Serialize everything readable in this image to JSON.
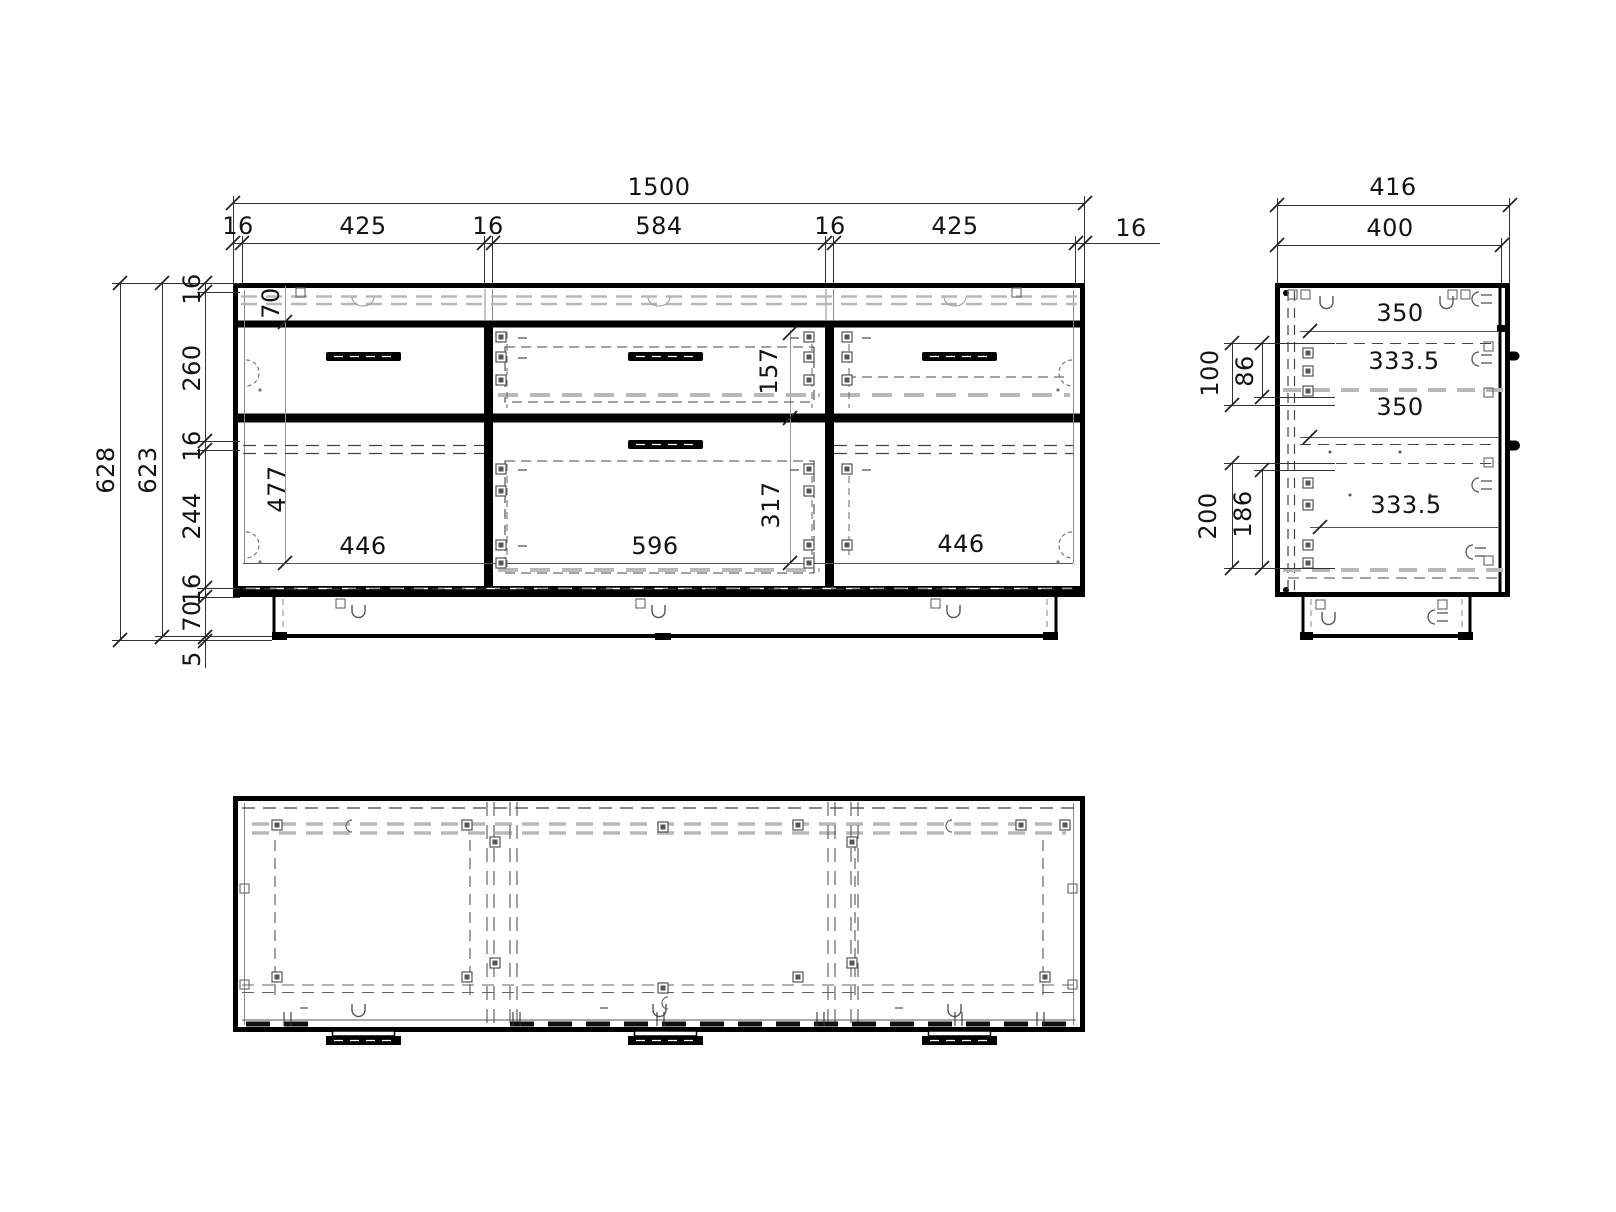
{
  "drawing": {
    "front": {
      "total_width": "1500",
      "width_segments": [
        "16",
        "425",
        "16",
        "584",
        "16",
        "425",
        "16"
      ],
      "total_height": "628",
      "body_height": "623",
      "height_segments": [
        "16",
        "260",
        "16",
        "244",
        "16",
        "70"
      ],
      "foot_height": "5",
      "top_rail_height": "70",
      "door_opening_height": "477",
      "left_door_width": "446",
      "top_drawer_front_height": "157",
      "bottom_drawer_front_height": "317",
      "drawer_front_width": "596",
      "right_door_width": "446"
    },
    "side": {
      "total_depth": "416",
      "body_depth": "400",
      "top_drawer_offset": "100",
      "top_drawer_inner": "86",
      "bottom_drawer_offset": "200",
      "bottom_drawer_inner": "186",
      "top_panel_depth": "350",
      "top_drawer_depth": "333.5",
      "shelf_depth": "350",
      "bottom_drawer_depth": "333.5"
    }
  }
}
